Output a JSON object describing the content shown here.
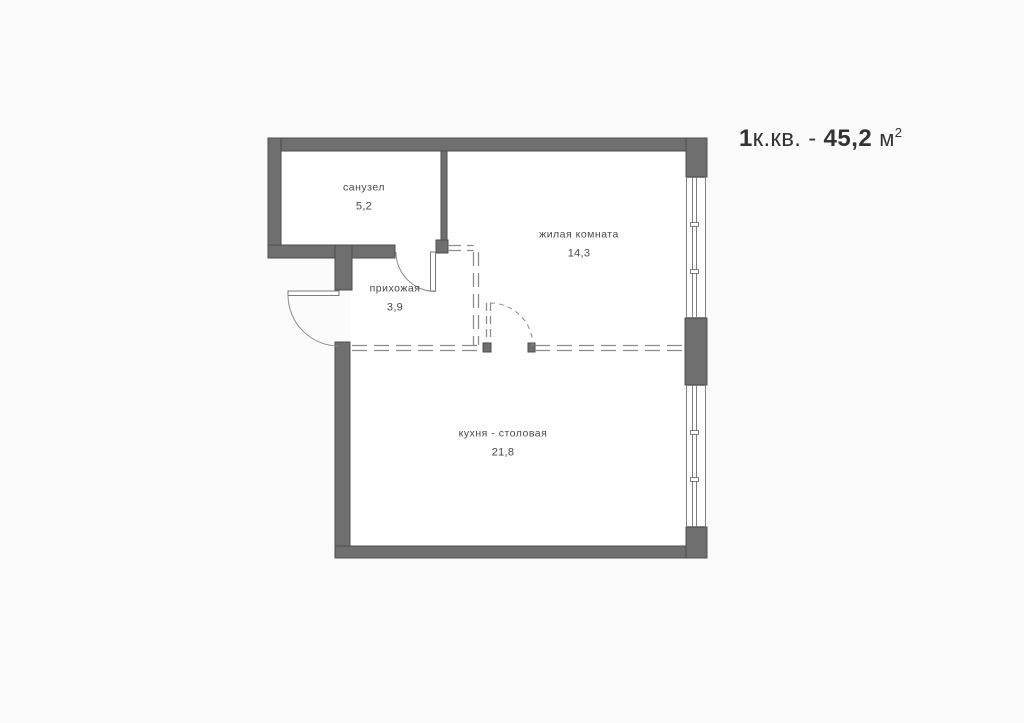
{
  "title": {
    "rooms_count": "1",
    "rooms_suffix": "к.кв.",
    "separator": "-",
    "area_value": "45,2",
    "unit": "м",
    "unit_sup": "2"
  },
  "rooms": [
    {
      "id": "bathroom",
      "name": "санузел",
      "area": "5,2"
    },
    {
      "id": "living",
      "name": "жилая комната",
      "area": "14,3"
    },
    {
      "id": "hallway",
      "name": "прихожая",
      "area": "3,9"
    },
    {
      "id": "kitchen",
      "name": "кухня - столовая",
      "area": "21,8"
    }
  ],
  "plan_elements": {
    "windows": [
      "window-top-right",
      "window-bottom-right"
    ],
    "doors": [
      "entry-door",
      "bathroom-door",
      "planned-door-dashed"
    ],
    "partitions": [
      "dashed-future-partition-vertical",
      "dashed-future-partition-horizontal"
    ]
  },
  "colors": {
    "background": "#FBFBFB",
    "room_fill": "#FFFFFF",
    "wall_fill": "#6F6F6F",
    "wall_outline": "#4E4E4E",
    "thin_line": "#8C8C8C",
    "label_text": "#4A4A4A",
    "title_text": "#333333"
  }
}
